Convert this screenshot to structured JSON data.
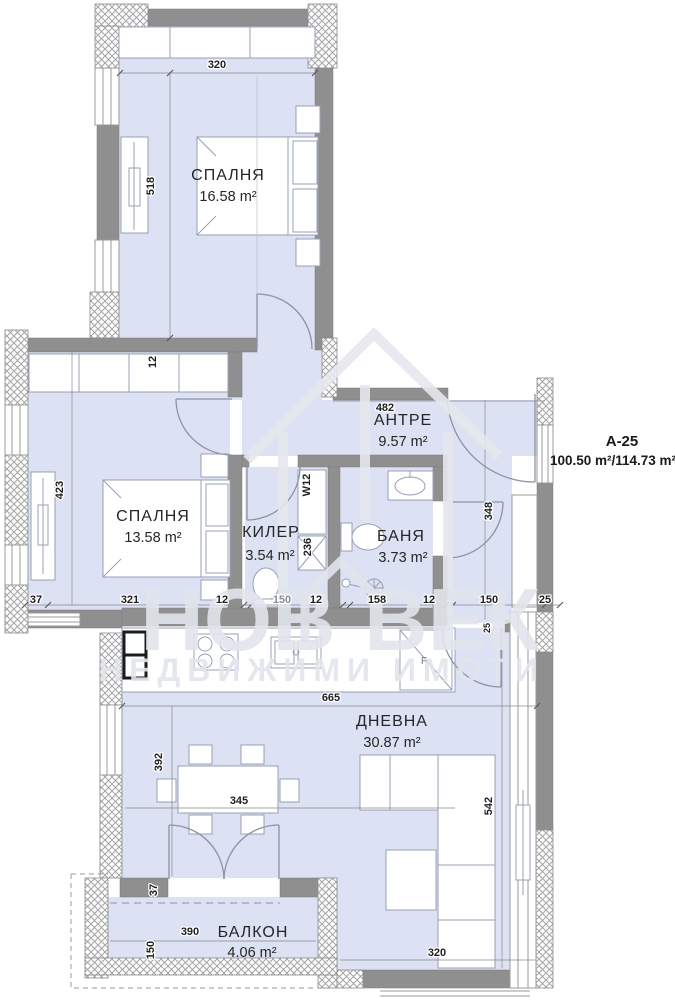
{
  "title": {
    "unit": "A-25",
    "area": "100.50 m²/114.73 m²"
  },
  "rooms": {
    "bedroom1": {
      "name": "СПАЛНЯ",
      "area": "16.58 m²"
    },
    "bedroom2": {
      "name": "СПАЛНЯ",
      "area": "13.58 m²"
    },
    "closet": {
      "name": "КИЛЕР",
      "area": "3.54 m²"
    },
    "bath": {
      "name": "БАНЯ",
      "area": "3.73 m²"
    },
    "hall": {
      "name": "АНТРЕ",
      "area": "9.57 m²"
    },
    "living": {
      "name": "ДНЕВНА",
      "area": "30.87 m²"
    },
    "balcony": {
      "name": "БАЛКОН",
      "area": "4.06 m²"
    }
  },
  "dims": {
    "top320": "320",
    "left518": "518",
    "wall12": "12",
    "hall482": "482",
    "bed423": "423",
    "corr348": "348",
    "duct_w12": "W12",
    "duct236": "236",
    "c37": "37",
    "c321": "321",
    "c12a": "12",
    "c150a": "150",
    "c12b": "12",
    "c158": "158",
    "c12c": "12",
    "c150b": "150",
    "c25": "25",
    "v25": "25",
    "lv665": "665",
    "lv392": "392",
    "lv345": "345",
    "lv542": "542",
    "bal37": "37",
    "bal390": "390",
    "bal150": "150",
    "bot320": "320"
  },
  "kitchen": {
    "fridge": "F"
  },
  "watermark": {
    "word1": "НОВ",
    "word2": "ВЕК",
    "line2": "НЕДВИЖИМИ ИМОТИ"
  },
  "colors": {
    "room_fill": "#dce1f3",
    "wall": "#8f8f8f",
    "furniture_line": "#98a0b4",
    "text": "#262626",
    "watermark": "#e2e5ec"
  }
}
